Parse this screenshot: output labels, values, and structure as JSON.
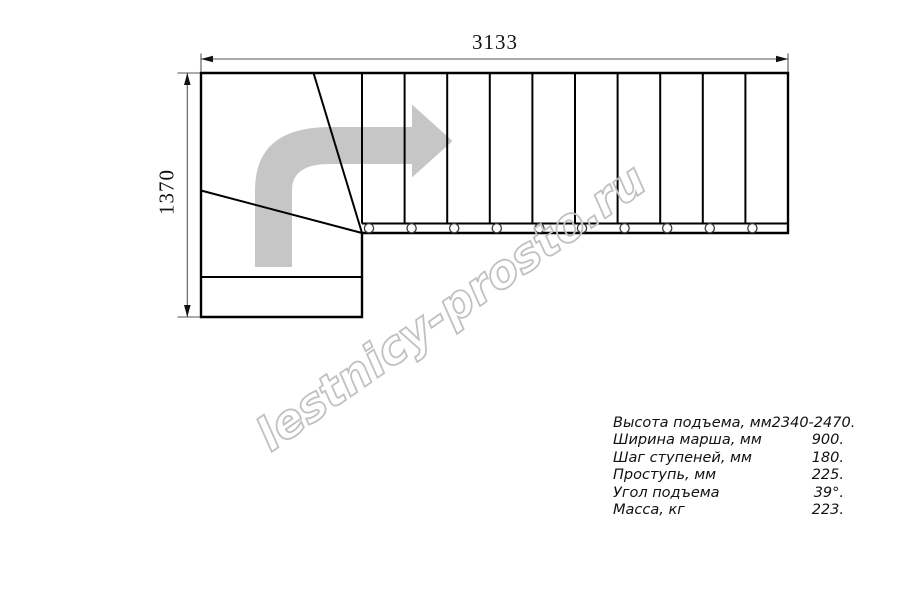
{
  "drawing": {
    "width_dimension": "3133",
    "depth_dimension": "1370",
    "straight_steps": 10,
    "winder_steps": 3,
    "balusters": 10,
    "line_color": "#000000",
    "arrow_color": "#c6c6c6"
  },
  "watermark": {
    "text": "lestnicy-prosto.ru",
    "color": "#c1c1c1"
  },
  "specs": {
    "rows": [
      {
        "label": "Высота подъема, мм",
        "value": "2340-2470."
      },
      {
        "label": "Ширина марша, мм",
        "value": "900."
      },
      {
        "label": "Шаг ступеней, мм",
        "value": "180."
      },
      {
        "label": "Проступь, мм",
        "value": "225."
      },
      {
        "label": "Угол подъема",
        "value": "39°."
      },
      {
        "label": "Масса, кг",
        "value": "223."
      }
    ]
  }
}
